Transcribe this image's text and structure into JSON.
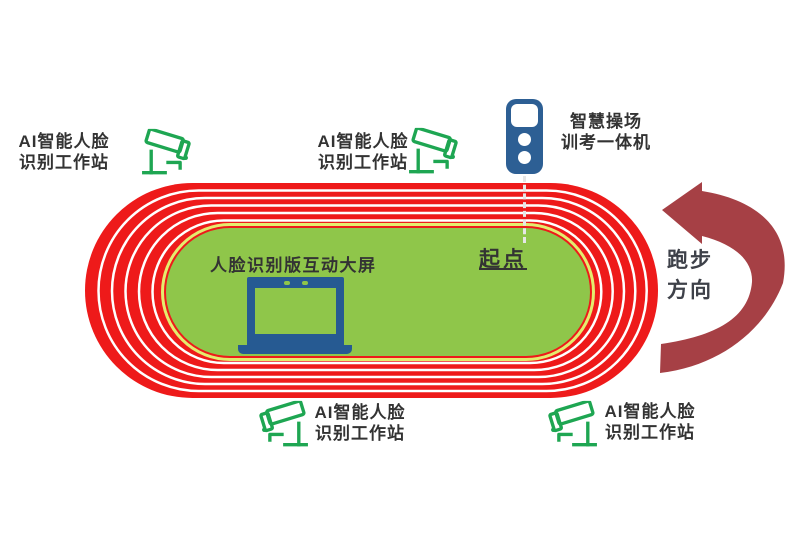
{
  "colors": {
    "track_red": "#ee1a1a",
    "lane_line": "#ffffff",
    "infield_green": "#8fc64a",
    "infield_border": "#e4ec6e",
    "camera_green": "#1ea652",
    "device_blue": "#2d5f94",
    "laptop_blue": "#265a92",
    "arrow_red": "#a64045",
    "text_dark": "#333333"
  },
  "icons": {
    "camera": "cctv-camera-icon",
    "terminal": "smart-track-terminal-icon",
    "laptop": "interactive-screen-icon",
    "arrow": "running-direction-arrow-icon"
  },
  "stations": {
    "top_left": {
      "line1": "AI智能人脸",
      "line2": "识别工作站"
    },
    "top_middle": {
      "line1": "AI智能人脸",
      "line2": "识别工作站"
    },
    "bottom_middle": {
      "line1": "AI智能人脸",
      "line2": "识别工作站"
    },
    "bottom_right": {
      "line1": "AI智能人脸",
      "line2": "识别工作站"
    }
  },
  "terminal": {
    "line1": "智慧操场",
    "line2": "训考一体机"
  },
  "infield": {
    "screen_label": "人脸识别版互动大屏",
    "start_label": "起点"
  },
  "direction": {
    "line1": "跑步",
    "line2": "方向"
  }
}
